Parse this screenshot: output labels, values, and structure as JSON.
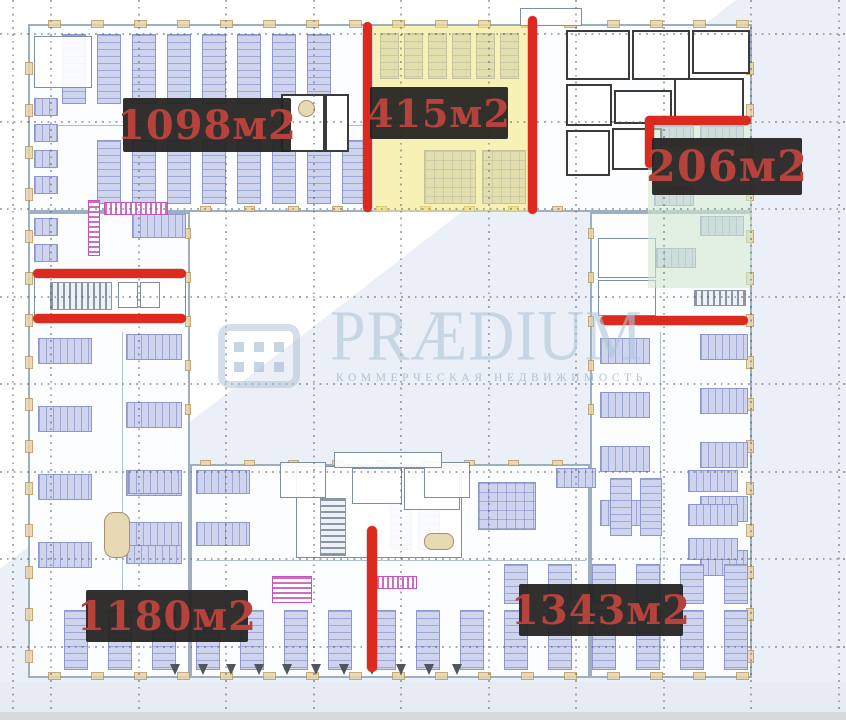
{
  "area_labels": [
    {
      "id": "zone-1098",
      "text": "1098м2"
    },
    {
      "id": "zone-415",
      "text": "415м2"
    },
    {
      "id": "zone-206",
      "text": "206м2"
    },
    {
      "id": "zone-1180",
      "text": "1180м2"
    },
    {
      "id": "zone-1343",
      "text": "1343м2"
    }
  ],
  "watermark": {
    "brand": "PRÆDIUM",
    "tagline": "КОММЕРЧЕСКАЯ НЕДВИЖИМОСТЬ",
    "logo_icon": "building-windows-icon"
  },
  "colors": {
    "highlight_red": "#dc2a1e",
    "label_background": "rgba(37,35,34,0.94)",
    "label_text": "#b5433b",
    "zone_yellow": "#f3e87a",
    "zone_green": "#cfe7cf",
    "watermark_blue": "#aec6da",
    "plan_line": "#9db0c2",
    "desk_fill": "#ced3ee",
    "facade_tan": "#e8d5a9"
  }
}
